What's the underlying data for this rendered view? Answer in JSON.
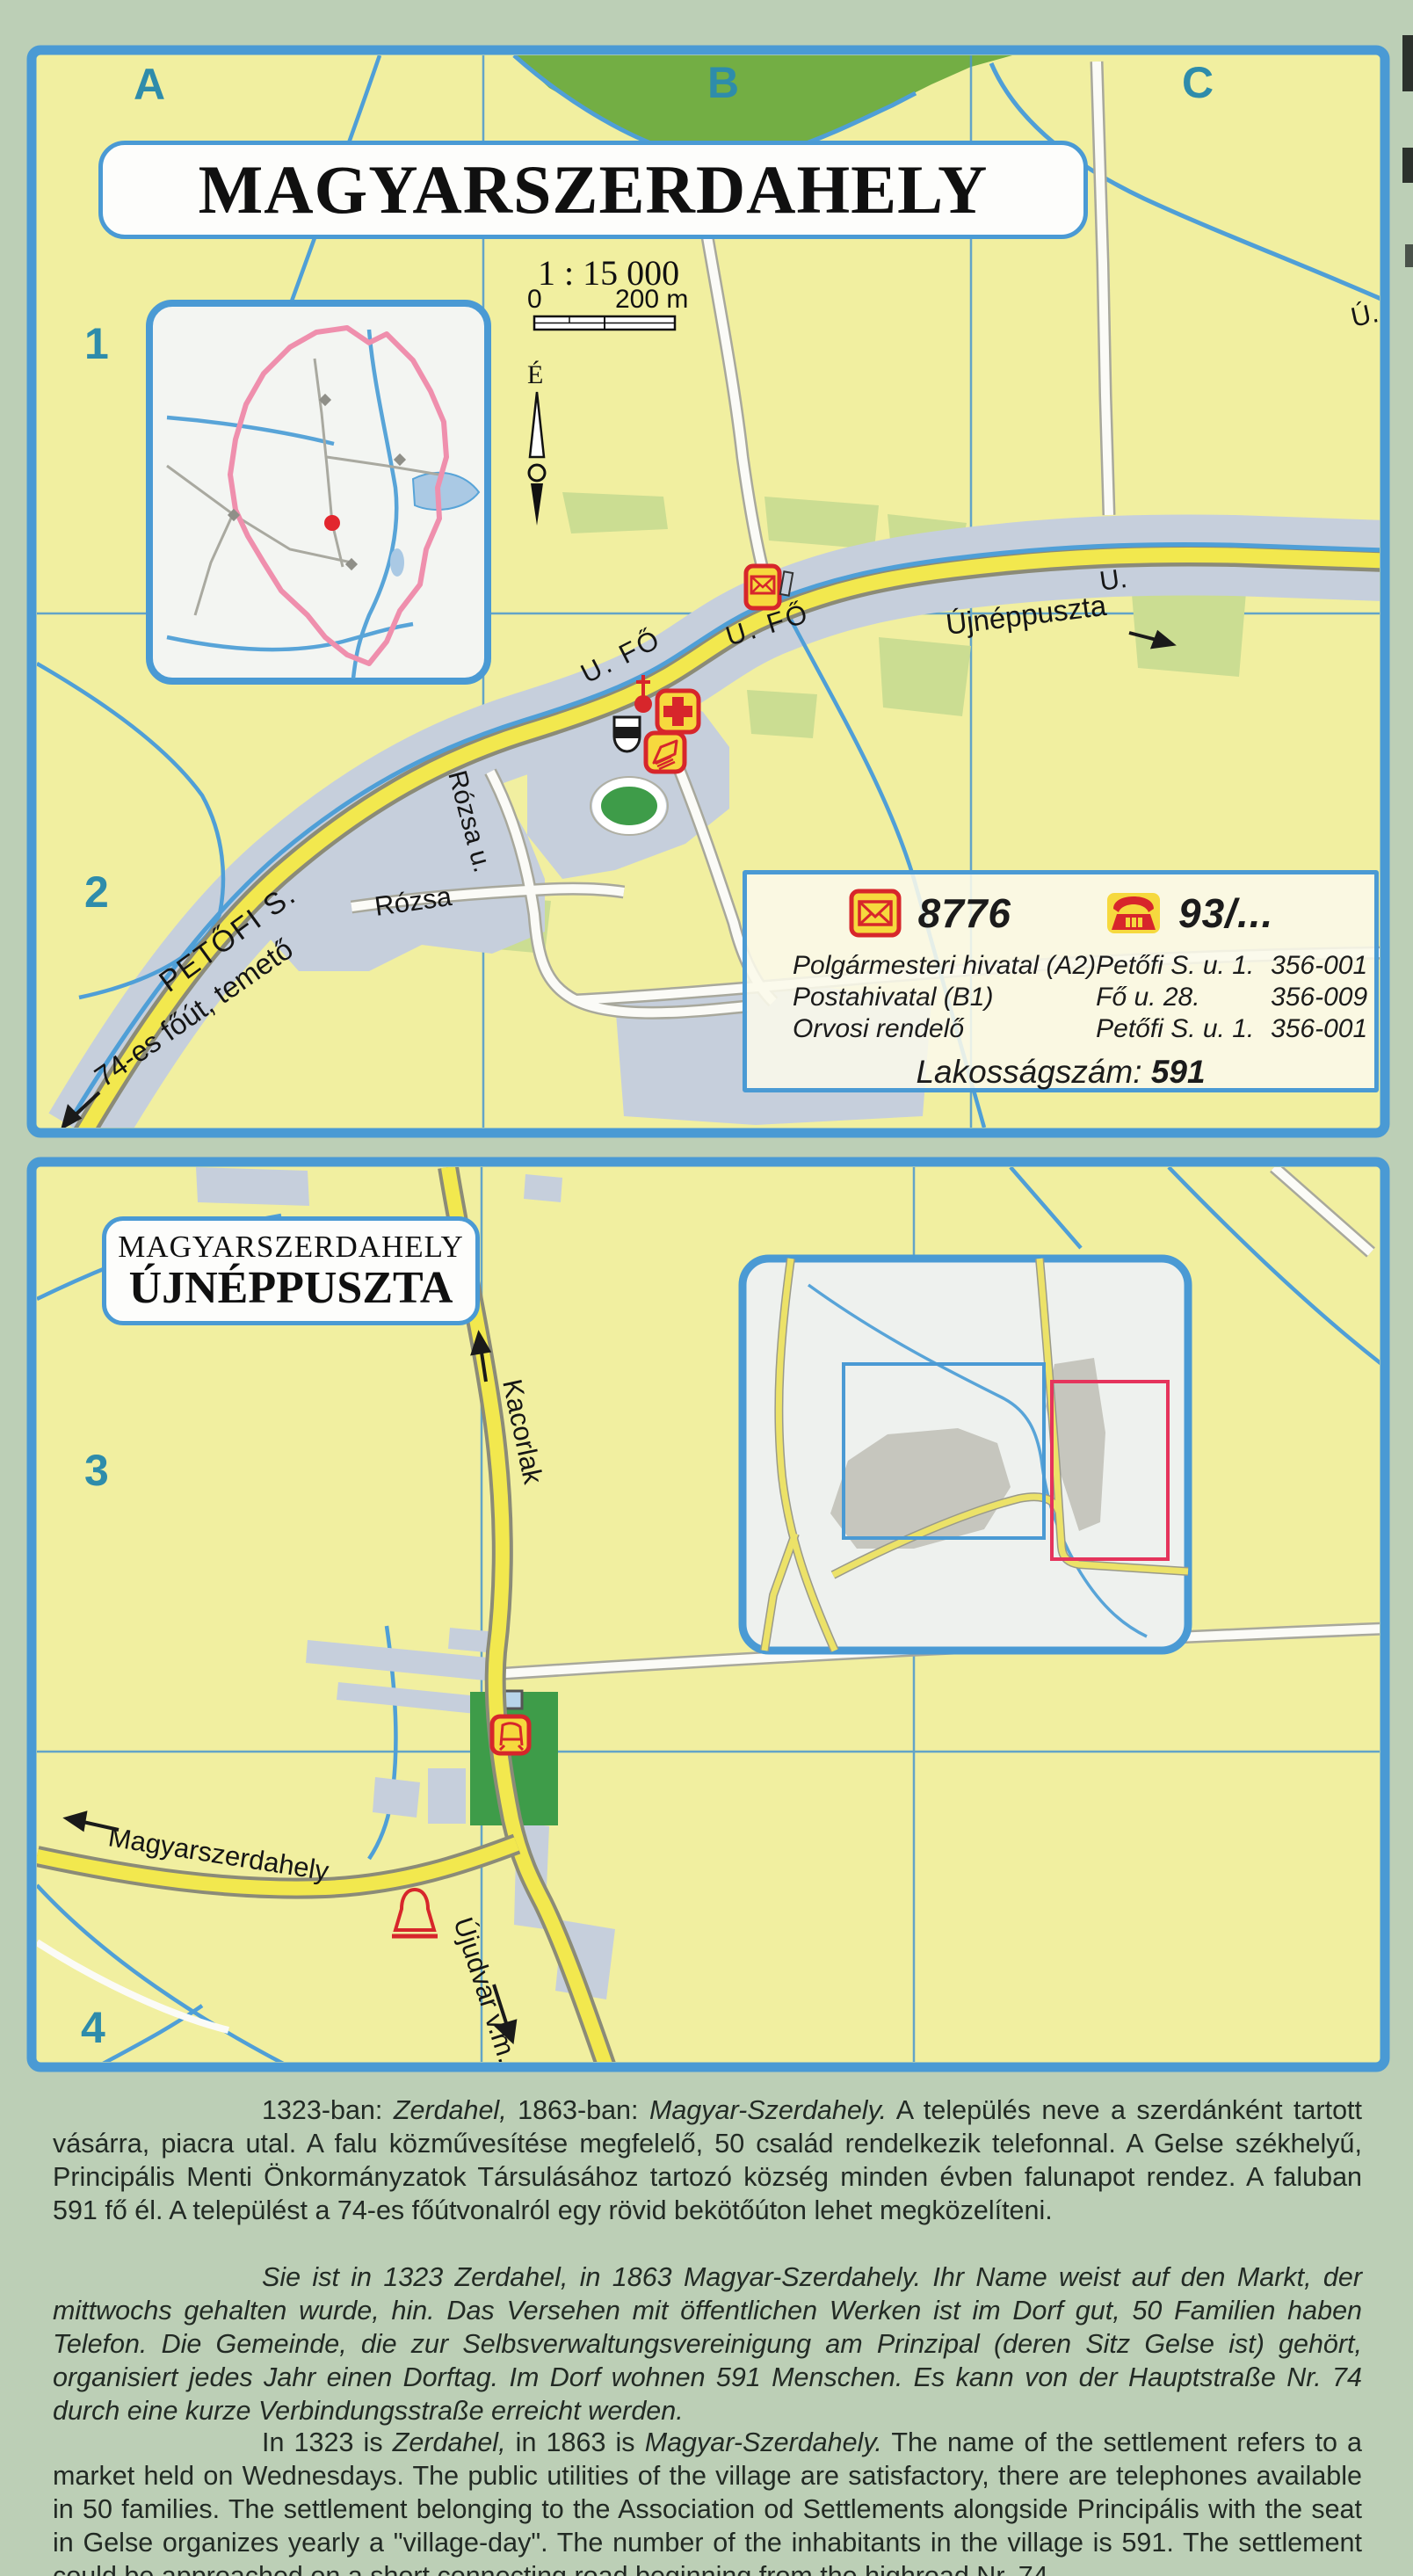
{
  "panel1": {
    "grid_cols": {
      "a": "A",
      "b": "B",
      "c": "C"
    },
    "grid_rows": {
      "r1": "1",
      "r2": "2"
    },
    "title": "MAGYARSZERDAHELY",
    "scale_ratio": "1 : 15 000",
    "scale_zero": "0",
    "scale_max": "200 m",
    "north_label": "É",
    "labels": {
      "fo_a": "U. FŐ",
      "fo_b": "U. FŐ",
      "u_short": "U.",
      "u_far": "Ú.",
      "ujneppuszta": "Újnéppuszta",
      "petofi": "PETŐFI S.",
      "rozsa": "Rózsa",
      "rozsa_u": "Rózsa u.",
      "fout74": "74-es főút, temető"
    },
    "infobox": {
      "postal_code": "8776",
      "phone_prefix": "93/...",
      "rows": [
        {
          "name": "Polgármesteri hivatal (A2)",
          "address": "Petőfi S. u. 1.",
          "phone": "356-001"
        },
        {
          "name": "Postahivatal (B1)",
          "address": "Fő u. 28.",
          "phone": "356-009"
        },
        {
          "name": "Orvosi rendelő",
          "address": "Petőfi S. u. 1.",
          "phone": "356-001"
        }
      ],
      "population_label": "Lakosságszám:",
      "population_value": "591"
    },
    "colors": {
      "border": "#4a9ad4",
      "map_bg": "#f1efa0",
      "road_yellow": "#f2e84e",
      "builtup": "#c6cfdc",
      "forest": "#73ae44",
      "stream": "#4f9fd7",
      "icon_red": "#d7262b",
      "icon_yellow": "#f6d93e",
      "boundary_pink": "#ef8fad"
    }
  },
  "panel2": {
    "grid_rows": {
      "r3": "3",
      "r4": "4"
    },
    "title_line1": "MAGYARSZERDAHELY",
    "title_line2": "ÚJNÉPPUSZTA",
    "labels": {
      "kacorlak": "Kacorlak",
      "magyarszerdahely": "Magyarszerdahely",
      "ujudvar": "Újudvar v.m."
    }
  },
  "paragraphs": {
    "hu": {
      "lead": "1323-ban: ",
      "italic1": "Zerdahel,",
      "mid": " 1863-ban: ",
      "italic2": "Magyar-Szerdahely.",
      "rest": " A település neve a szerdánként tartott vásárra, piacra utal. A falu közművesítése megfelelő, 50 család rendelkezik telefonnal. A Gelse székhelyű, Principális Menti Önkormányzatok Társulásához tartozó község minden évben falunapot rendez. A faluban 591 fő él. A települést a 74-es főútvonalról egy rövid bekötőúton lehet megközelíteni."
    },
    "de": {
      "text": "Sie ist in 1323 Zerdahel, in 1863 Magyar-Szerdahely. Ihr Name weist auf den Markt, der mittwochs gehalten wurde, hin. Das Versehen mit öffentlichen Werken ist im Dorf gut, 50 Familien haben Telefon. Die Gemeinde, die zur Selbsverwaltungsvereinigung am Prinzipal (deren Sitz Gelse ist) gehört, organisiert jedes Jahr einen Dorftag. Im Dorf wohnen 591 Menschen. Es kann von der Hauptstraße Nr. 74 durch eine kurze Verbindungsstraße erreicht werden."
    },
    "en": {
      "lead": "In 1323 is ",
      "italic1": "Zerdahel,",
      "mid": " in 1863 is ",
      "italic2": "Magyar-Szerdahely.",
      "rest": " The name of the settlement refers to a market held on Wednesdays. The public utilities of the village are satisfactory, there are telephones available in 50 families. The settlement belonging to the Association od Settlements alongside Principális with the seat in Gelse organizes yearly a \"village-day\". The number of the inhabitants in the village is 591. The settlement could be approached on a short connecting road beginning from the highroad Nr. 74."
    }
  }
}
